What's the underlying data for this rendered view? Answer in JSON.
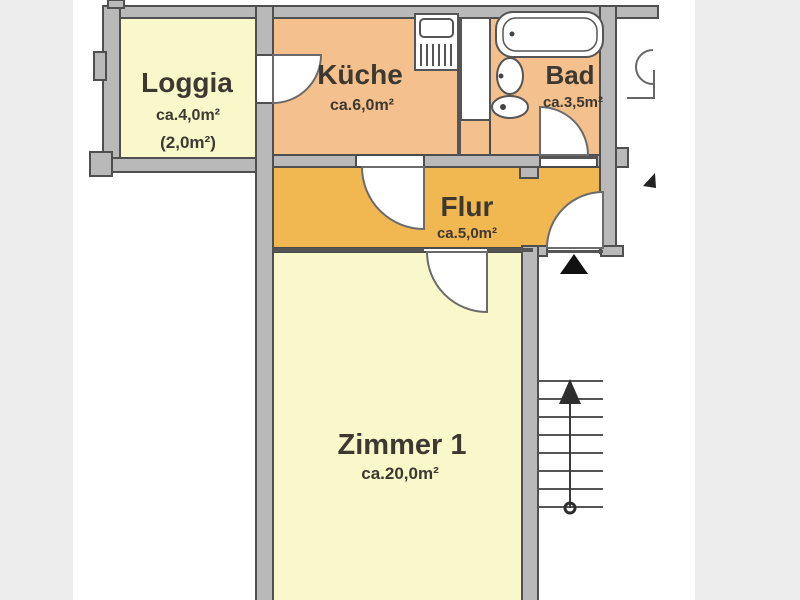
{
  "floorplan": {
    "title": "apartment-floorplan",
    "colors": {
      "page_background": "#ededed",
      "canvas": "#ffffff",
      "wall_fill": "#b9b9b9",
      "wall_outline": "#4f4f4f",
      "thin_line": "#555555",
      "door_line": "#6b6b6b",
      "label": "#3e3930",
      "room_yellow": "#f8f8cb",
      "room_peach": "#f4c08e",
      "room_amber": "#f1b751",
      "marker_black": "#111111"
    },
    "rooms": [
      {
        "name": "Loggia",
        "area": "ca.4,0m²",
        "area_secondary": "(2,0m²)",
        "fill": "#f8f8cb"
      },
      {
        "name": "Küche",
        "area": "ca.6,0m²",
        "fill": "#f4c08e"
      },
      {
        "name": "Bad",
        "area": "ca.3,5m²",
        "fill": "#f4c08e"
      },
      {
        "name": "Flur",
        "area": "ca.5,0m²",
        "fill": "#f1b751"
      },
      {
        "name": "Zimmer 1",
        "area": "ca.20,0m²",
        "fill": "#f8f8cb"
      }
    ],
    "symbols": [
      "bathtub",
      "washbasin",
      "toilet",
      "kitchen-unit",
      "staircase-with-up-arrow",
      "entrance-triangle-marker",
      "door-swing-loggia",
      "door-swing-kueche",
      "door-swing-bad",
      "door-swing-zimmer1",
      "door-swing-entrance"
    ]
  }
}
